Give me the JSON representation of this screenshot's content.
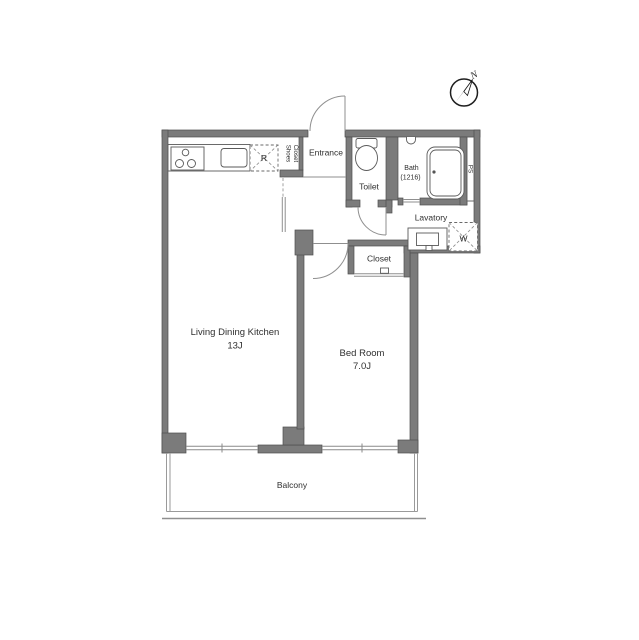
{
  "floor_plan": {
    "compass": {
      "north_label": "N"
    },
    "rooms": {
      "living_dining_kitchen": {
        "name": "Living Dining Kitchen",
        "size": "13J"
      },
      "bed_room": {
        "name": "Bed Room",
        "size": "7.0J"
      },
      "balcony": {
        "name": "Balcony"
      },
      "entrance": {
        "name": "Entrance"
      },
      "toilet": {
        "name": "Toilet"
      },
      "bath": {
        "name": "Bath",
        "size": "(1216)"
      },
      "lavatory": {
        "name": "Lavatory"
      },
      "closet": {
        "name": "Closet"
      },
      "shoes_closet": {
        "name_line1": "Shoes",
        "name_line2": "Closet"
      }
    },
    "labels": {
      "refrigerator": "R",
      "washing_machine": "W",
      "pipe_space": "PS"
    },
    "colors": {
      "wall_fill": "#7b7b7b",
      "wall_outline": "#4f4f4f",
      "fixture_line": "#5a5a5a",
      "text": "#2f2f2f",
      "background": "#ffffff"
    }
  }
}
